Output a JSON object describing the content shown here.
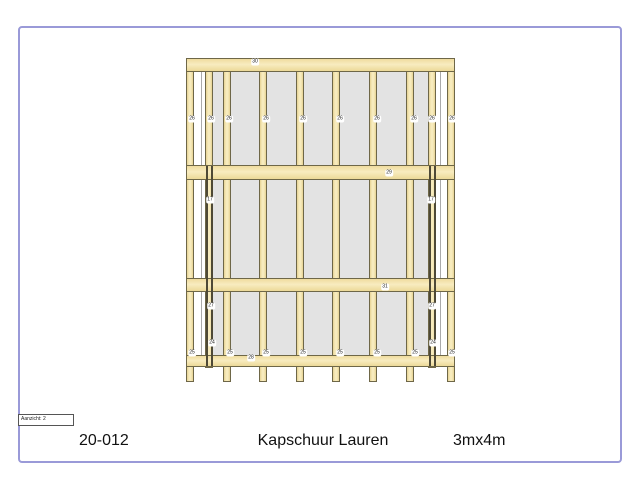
{
  "page": {
    "border_color": "#9a9ad8",
    "background": "#ffffff"
  },
  "title_block": {
    "project_number": "20-012",
    "title": "Kapschuur Lauren",
    "size": "3mx4m",
    "view_label": "Aanzicht: 2"
  },
  "drawing": {
    "colors": {
      "wood_fill": "#f4e4aa",
      "wood_edge": "#6e6748",
      "panel_fill": "#e3e3e3",
      "panel_line": "#aaaaaa",
      "dark_stud": "#4e4936",
      "label_bg": "#ffffff",
      "label_text": "#222222"
    },
    "panels": [
      {
        "x": 205,
        "y": 72,
        "w": 231,
        "h": 283
      }
    ],
    "baylines": [
      {
        "x": 201,
        "y": 72,
        "h": 283
      },
      {
        "x": 440,
        "y": 72,
        "h": 283
      }
    ],
    "posts": [
      {
        "x": 186,
        "y": 58,
        "w": 8,
        "h": 324
      },
      {
        "x": 205,
        "y": 58,
        "w": 8,
        "h": 310
      },
      {
        "x": 223,
        "y": 58,
        "w": 8,
        "h": 324
      },
      {
        "x": 259,
        "y": 58,
        "w": 8,
        "h": 324
      },
      {
        "x": 296,
        "y": 58,
        "w": 8,
        "h": 324
      },
      {
        "x": 332,
        "y": 58,
        "w": 8,
        "h": 324
      },
      {
        "x": 369,
        "y": 58,
        "w": 8,
        "h": 324
      },
      {
        "x": 406,
        "y": 58,
        "w": 8,
        "h": 324
      },
      {
        "x": 428,
        "y": 58,
        "w": 8,
        "h": 310
      },
      {
        "x": 447,
        "y": 58,
        "w": 8,
        "h": 324
      }
    ],
    "beams": [
      {
        "x": 186,
        "y": 58,
        "w": 269,
        "h": 14
      },
      {
        "x": 186,
        "y": 165,
        "w": 269,
        "h": 15
      },
      {
        "x": 186,
        "y": 278,
        "w": 269,
        "h": 14
      },
      {
        "x": 186,
        "y": 355,
        "w": 269,
        "h": 12
      }
    ],
    "studs": [
      {
        "x": 206,
        "y": 166,
        "h": 200
      },
      {
        "x": 211,
        "y": 166,
        "h": 200
      },
      {
        "x": 429,
        "y": 166,
        "h": 200
      },
      {
        "x": 434,
        "y": 166,
        "h": 200
      }
    ],
    "part_labels": [
      {
        "t": "30",
        "x": 255,
        "y": 62
      },
      {
        "t": "26",
        "x": 192,
        "y": 119
      },
      {
        "t": "26",
        "x": 211,
        "y": 119
      },
      {
        "t": "26",
        "x": 229,
        "y": 119
      },
      {
        "t": "26",
        "x": 266,
        "y": 119
      },
      {
        "t": "26",
        "x": 303,
        "y": 119
      },
      {
        "t": "26",
        "x": 340,
        "y": 119
      },
      {
        "t": "26",
        "x": 377,
        "y": 119
      },
      {
        "t": "26",
        "x": 414,
        "y": 119
      },
      {
        "t": "26",
        "x": 432,
        "y": 119
      },
      {
        "t": "26",
        "x": 452,
        "y": 119
      },
      {
        "t": "29",
        "x": 389,
        "y": 173
      },
      {
        "t": "17",
        "x": 210,
        "y": 200
      },
      {
        "t": "17",
        "x": 431,
        "y": 200
      },
      {
        "t": "31",
        "x": 385,
        "y": 287
      },
      {
        "t": "27",
        "x": 211,
        "y": 306
      },
      {
        "t": "27",
        "x": 432,
        "y": 306
      },
      {
        "t": "24",
        "x": 212,
        "y": 343
      },
      {
        "t": "24",
        "x": 433,
        "y": 343
      },
      {
        "t": "25",
        "x": 192,
        "y": 353
      },
      {
        "t": "25",
        "x": 230,
        "y": 353
      },
      {
        "t": "25",
        "x": 266,
        "y": 353
      },
      {
        "t": "25",
        "x": 303,
        "y": 353
      },
      {
        "t": "25",
        "x": 340,
        "y": 353
      },
      {
        "t": "25",
        "x": 377,
        "y": 353
      },
      {
        "t": "25",
        "x": 415,
        "y": 353
      },
      {
        "t": "25",
        "x": 452,
        "y": 353
      },
      {
        "t": "28",
        "x": 251,
        "y": 358
      }
    ]
  }
}
